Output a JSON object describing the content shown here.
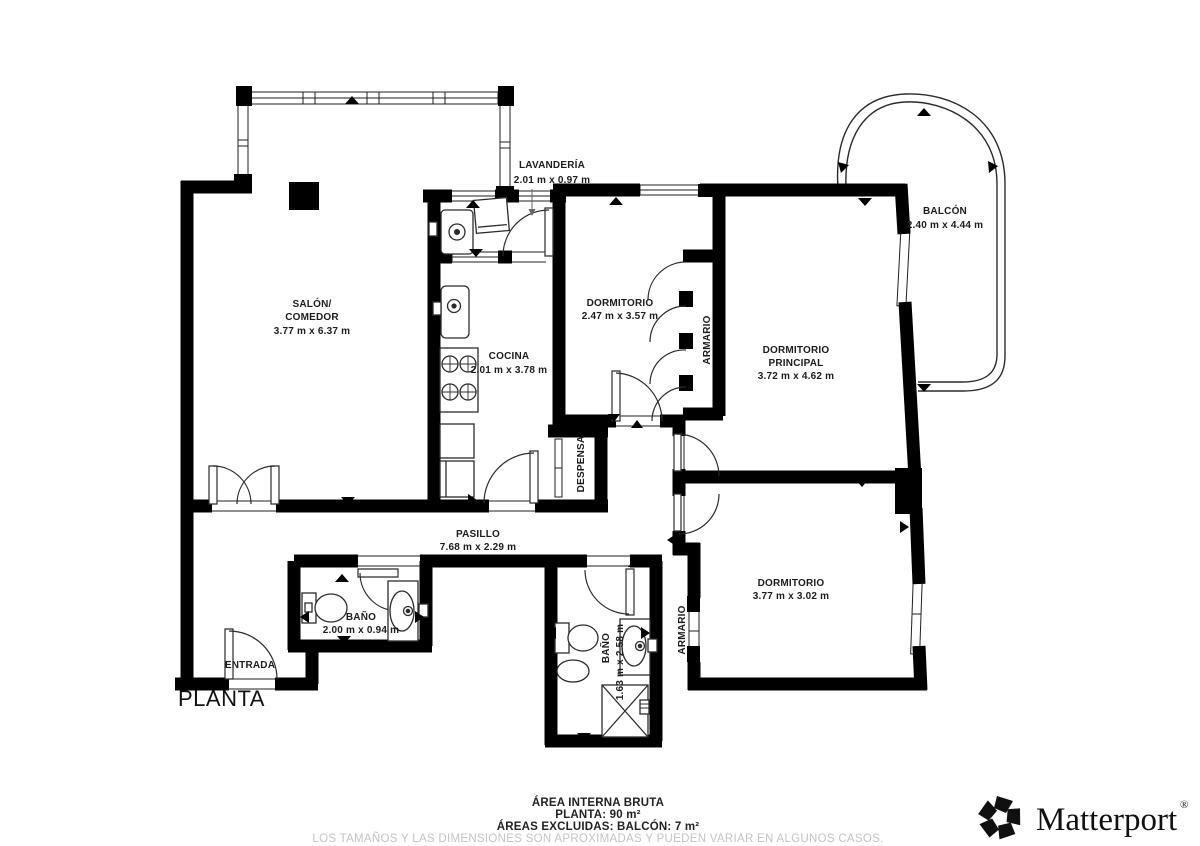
{
  "floor_plan": {
    "plan_label": "PLANTA",
    "rooms": {
      "lavanderia": {
        "name": "LAVANDERÍA",
        "dims": "2.01 m x 0.97 m"
      },
      "salon": {
        "name": "SALÓN/",
        "name2": "COMEDOR",
        "dims": "3.77 m x 6.37 m"
      },
      "cocina": {
        "name": "COCINA",
        "dims": "2.01 m x 3.78 m"
      },
      "dormitorio1": {
        "name": "DORMITORIO",
        "dims": "2.47 m x 3.57 m"
      },
      "armario1": {
        "name": "ARMARIO"
      },
      "dormitorio_principal": {
        "name": "DORMITORIO",
        "name2": "PRINCIPAL",
        "dims": "3.72 m x 4.62 m"
      },
      "balcon": {
        "name": "BALCÓN",
        "dims": "2.40 m x 4.44 m"
      },
      "despensa": {
        "name": "DESPENSA"
      },
      "pasillo": {
        "name": "PASILLO",
        "dims": "7.68 m x 2.29 m"
      },
      "bano1": {
        "name": "BAÑO",
        "dims": "2.00 m x 0.94 m"
      },
      "entrada": {
        "name": "ENTRADA"
      },
      "bano2": {
        "name": "BAÑO",
        "dims": "1.63 m x 2.58 m"
      },
      "armario2": {
        "name": "ARMARIO"
      },
      "dormitorio2": {
        "name": "DORMITORIO",
        "dims": "3.77 m x 3.02 m"
      }
    }
  },
  "footer": {
    "area_line": "ÁREA INTERNA BRUTA",
    "planta_line": "PLANTA: 90 m²",
    "excluded_line": "ÁREAS EXCLUIDAS: BALCÓN: 7 m²",
    "disclaimer": "LOS TAMAÑOS Y LAS DIMENSIONES SON APROXIMADAS Y PUEDEN VARIAR EN ALGUNOS CASOS."
  },
  "brand": {
    "wordmark": "Matterport",
    "registered": "®"
  },
  "icons": {
    "brand_icon": "matterport-pinwheel"
  },
  "colors": {
    "wall": "#000000",
    "label": "#1c1c1c",
    "disclaimer": "#c3c3c3",
    "background": "#ffffff"
  }
}
